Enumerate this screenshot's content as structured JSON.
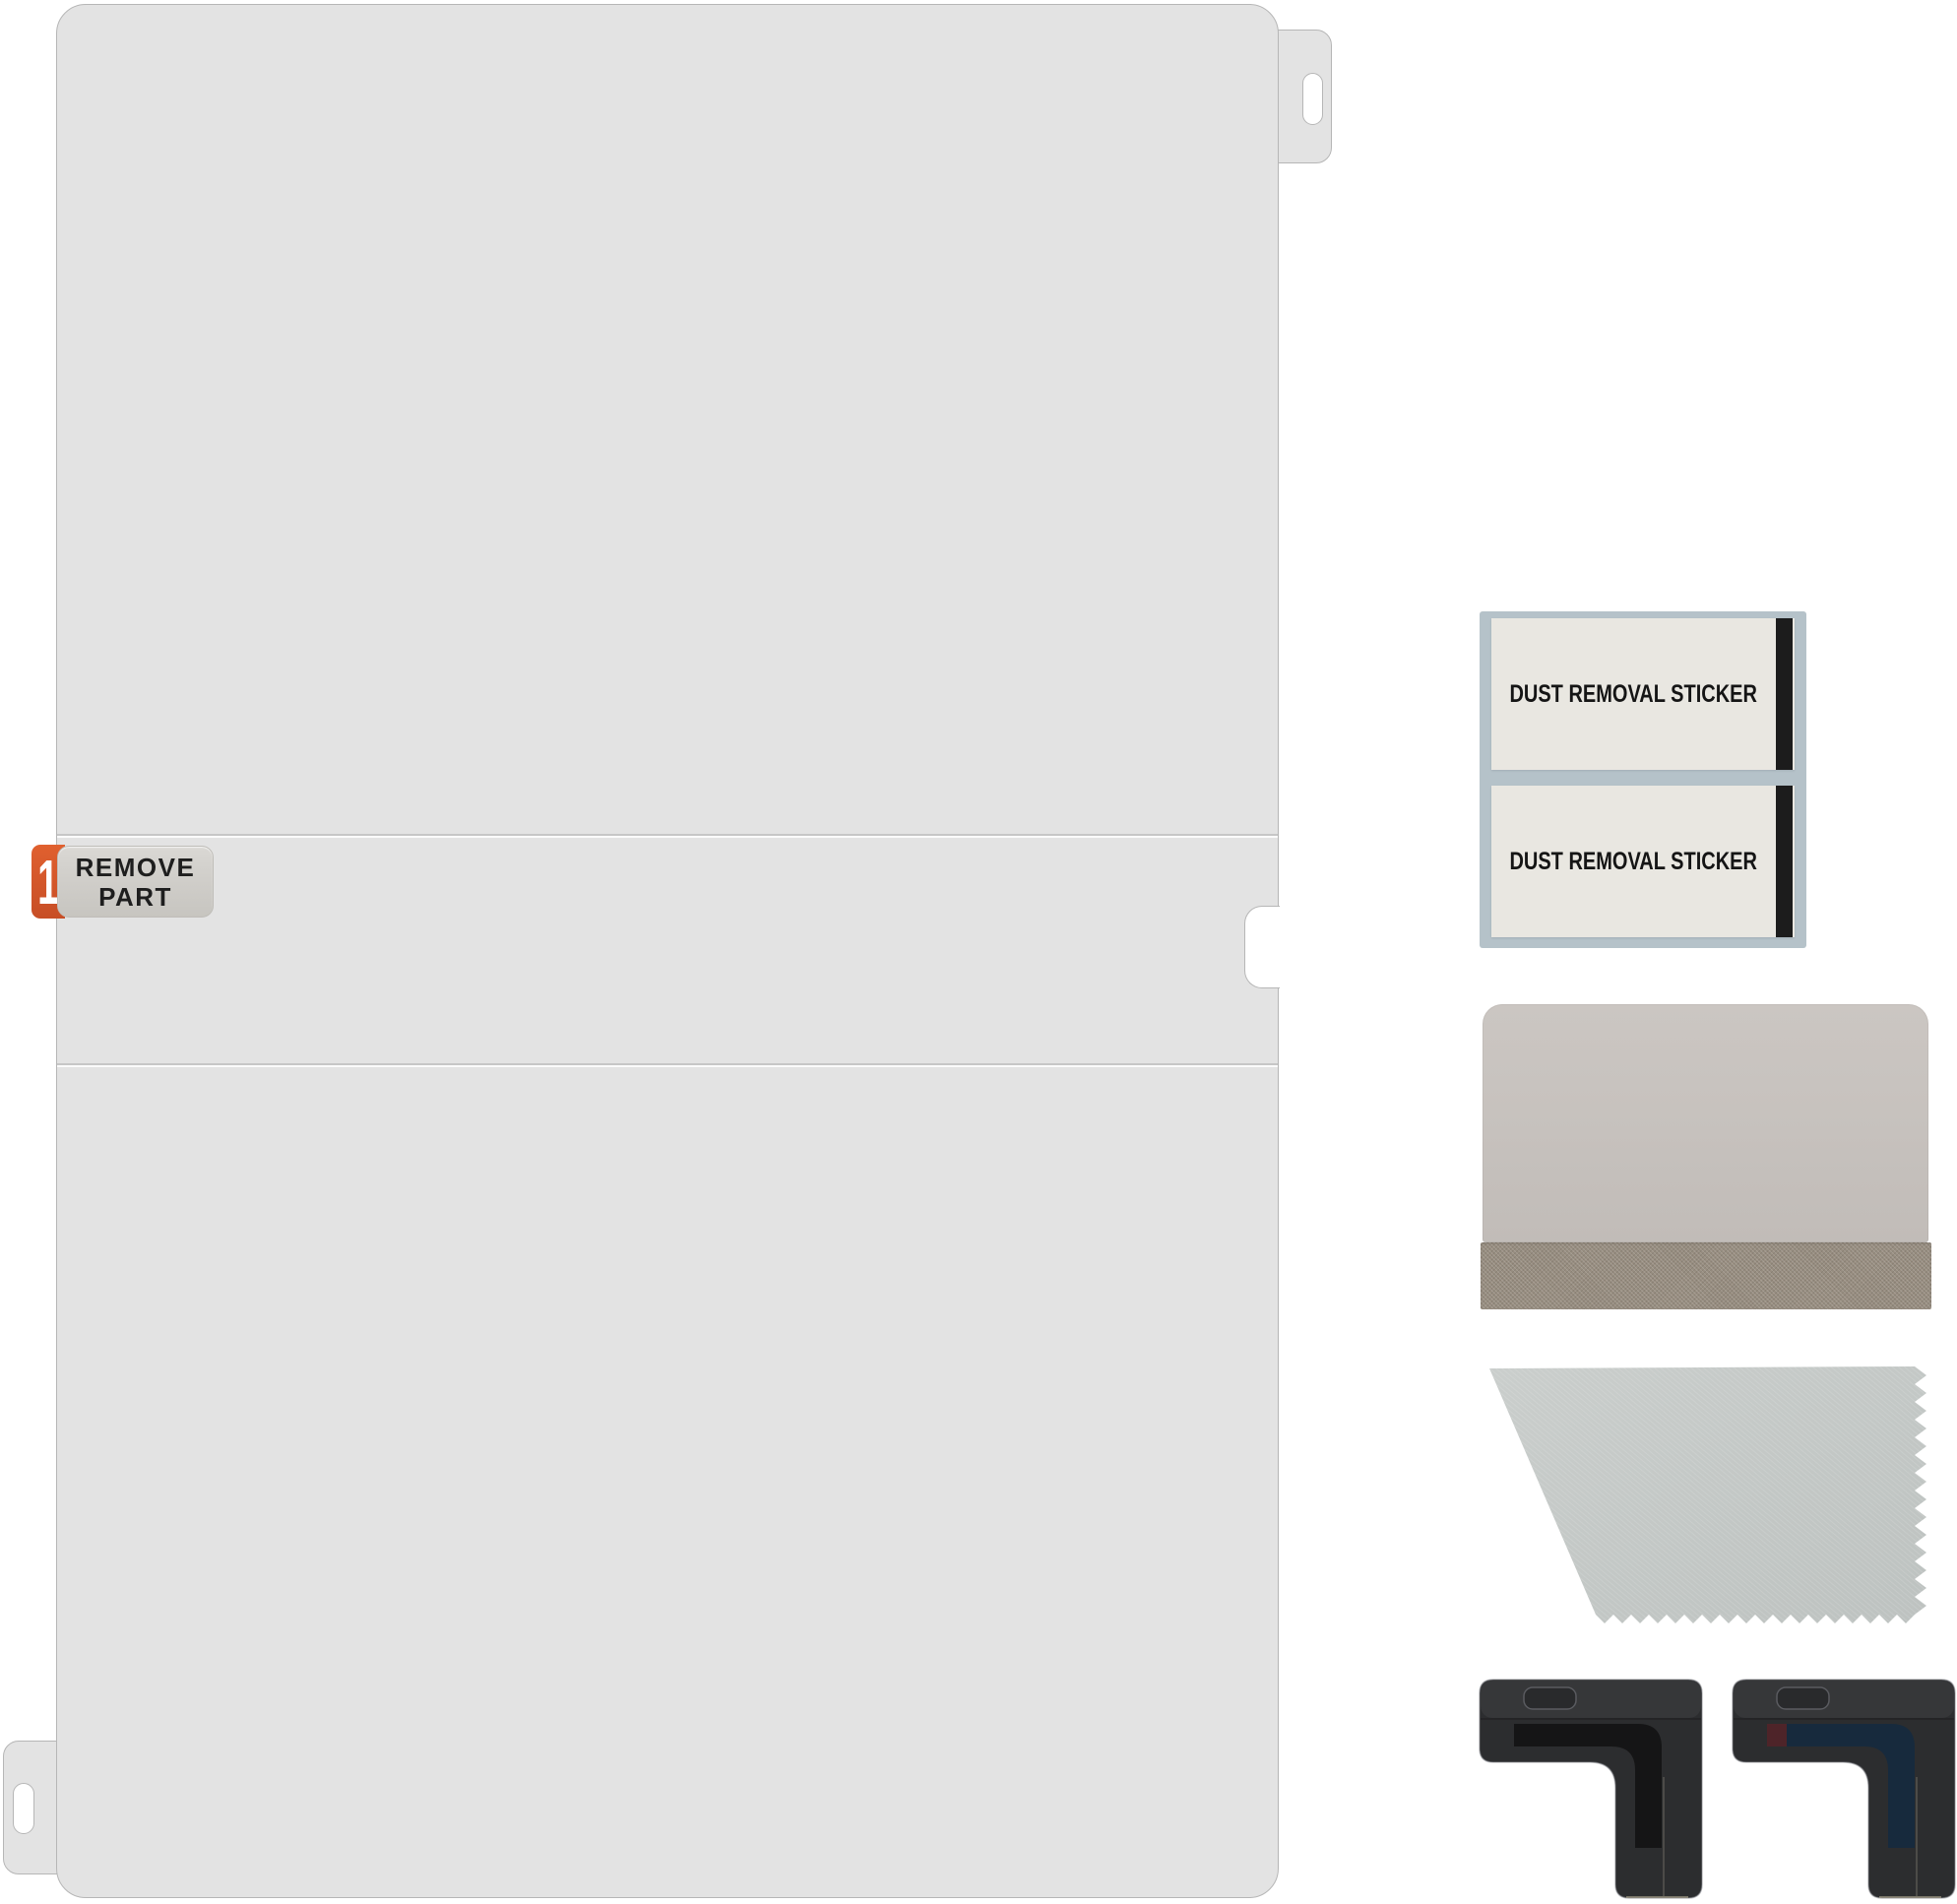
{
  "film": {
    "remove_tab": {
      "step": "1",
      "line1": "REMOVE",
      "line2": "PART"
    }
  },
  "stickers": {
    "items": [
      {
        "label": "DUST REMOVAL STICKER"
      },
      {
        "label": "DUST REMOVAL STICKER"
      }
    ]
  },
  "colors": {
    "background": "#ffffff",
    "film": "#e3e3e3",
    "film_border": "#b6b6b6",
    "seam": "#c6c6c6",
    "orange_tab": "#e0602f",
    "orange_tab_dark": "#c74e26",
    "step_number": "#ffffff",
    "label_bg": "#d3d1cd",
    "label_border": "#bfbdb8",
    "label_text": "#1e1e1e",
    "sticker_backing": "#b5c2c9",
    "sticker_face": "#e9e7e1",
    "sticker_bar": "#1c1c1c",
    "sticker_text": "#151515",
    "squeegee_card": "#c7c2be",
    "squeegee_fabric": "#978d80",
    "cloth_light": "#cacecc",
    "cloth_dark": "#bdc2c0",
    "guide_body": "#2c2d2f",
    "guide_inlay_dark": "#151516",
    "guide_inlay_blue": "#172a3d",
    "guide_inlay_red": "#4e2429"
  }
}
